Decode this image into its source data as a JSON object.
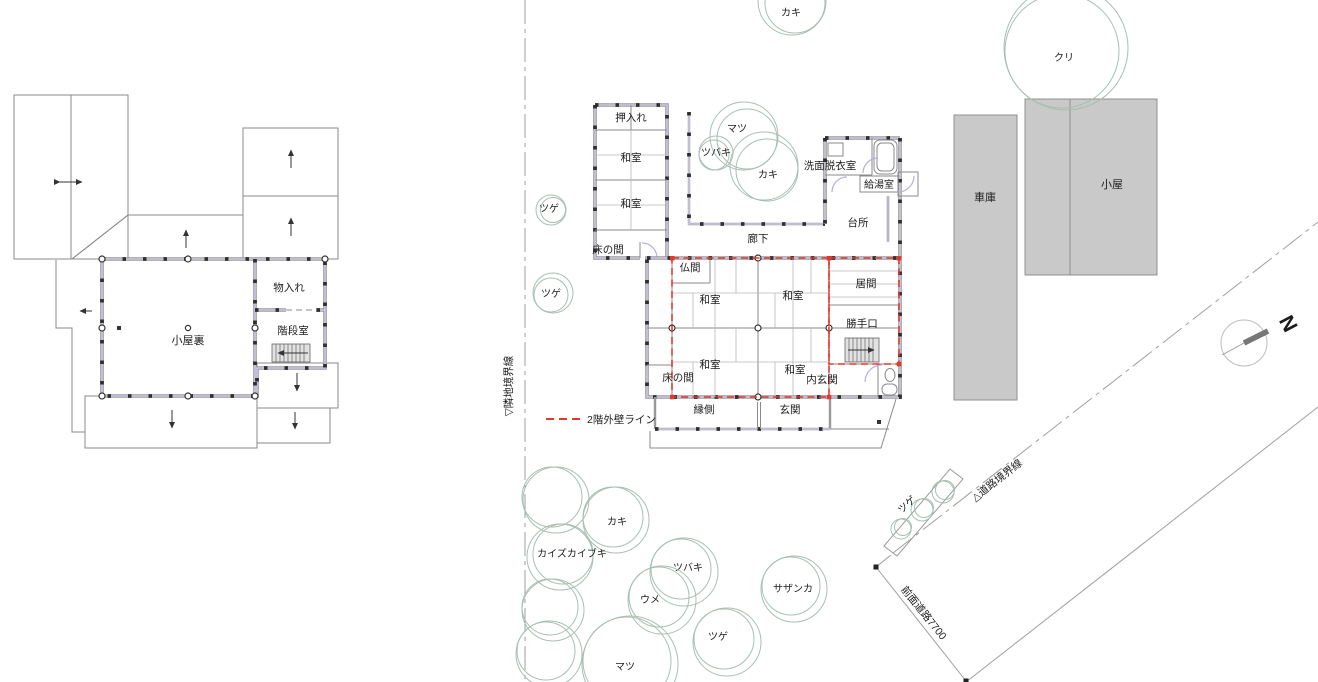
{
  "colors": {
    "red_dashed": "#e0392e",
    "wall_accent": "#cdc7e6",
    "tree_outline": "#a9bfb2",
    "building_fill": "#c9c9c9",
    "line_gray": "#9a9a9a"
  },
  "legend": {
    "second_floor_wall_line": "2階外壁ライン"
  },
  "boundaries": {
    "neighbor_line": "▽隣地境界線",
    "road_line": "△道路境界線",
    "front_road": "前面道路7700"
  },
  "compass": {
    "north": "N"
  },
  "upper_floor": {
    "attic": "小屋裏",
    "storage": "物入れ",
    "stair_room": "階段室"
  },
  "rooms_1f": {
    "oshiire": "押入れ",
    "washitsu_annex_north": "和室",
    "washitsu_annex_south": "和室",
    "tokonoma_annex": "床の間",
    "corridor": "廊下",
    "washroom": "洗面脱衣室",
    "water_heater": "給湯室",
    "kitchen": "台所",
    "butsuma": "仏間",
    "washitsu_nw": "和室",
    "washitsu_ne": "和室",
    "living": "居間",
    "back_door": "勝手口",
    "washitsu_sw": "和室",
    "washitsu_se": "和室",
    "tokonoma_main": "床の間",
    "inner_entrance": "内玄関",
    "veranda": "縁側",
    "entrance": "玄関"
  },
  "site": {
    "garage": "車庫",
    "shed": "小屋"
  },
  "trees": {
    "kaki_top": "カキ",
    "kuri": "クリ",
    "matsu_top": "マツ",
    "tsubaki_top": "ツバキ",
    "kaki_mid": "カキ",
    "tsuge_left_upper": "ツゲ",
    "tsuge_left_lower": "ツゲ",
    "kaki_sw": "カキ",
    "kaizukaibuki": "カイズカイブキ",
    "tsubaki_sw": "ツバキ",
    "ume": "ウメ",
    "sazanka": "サザンカ",
    "tsuge_south": "ツゲ",
    "matsu_south": "マツ",
    "tsuge_hedge": "ツゲ"
  }
}
